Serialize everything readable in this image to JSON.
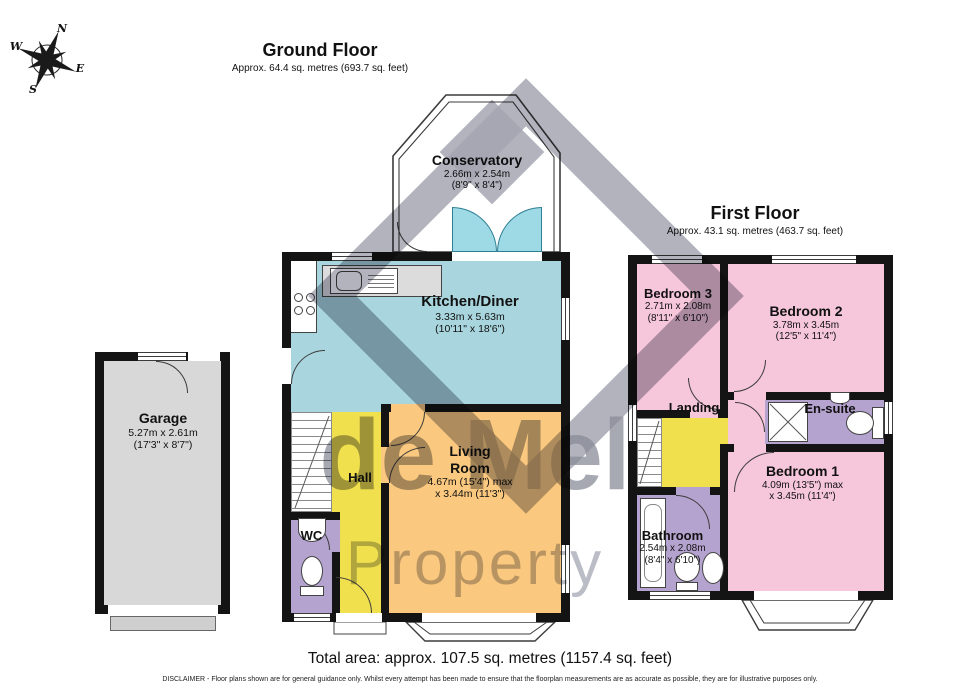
{
  "meta": {
    "background": "#ffffff"
  },
  "compass": {
    "n": "N",
    "e": "E",
    "s": "S",
    "w": "W"
  },
  "watermark": {
    "line1": "de Mel",
    "line2": "Property"
  },
  "floors": [
    {
      "title": "Ground Floor",
      "subtitle": "Approx. 64.4 sq. metres (693.7 sq. feet)",
      "rooms": [
        {
          "name": "Conservatory",
          "dims_m": "2.66m x 2.54m",
          "dims_ft": "(8'9\" x 8'4\")"
        },
        {
          "name": "Kitchen/Diner",
          "dims_m": "3.33m x 5.63m",
          "dims_ft": "(10'11\" x 18'6\")"
        },
        {
          "name": "Living Room",
          "dims_m": "4.67m (15'4\") max",
          "dims_ft": "x 3.44m (11'3\")"
        },
        {
          "name": "Hall"
        },
        {
          "name": "WC"
        },
        {
          "name": "Garage",
          "dims_m": "5.27m x 2.61m",
          "dims_ft": "(17'3\" x 8'7\")"
        }
      ]
    },
    {
      "title": "First Floor",
      "subtitle": "Approx. 43.1 sq. metres (463.7 sq. feet)",
      "rooms": [
        {
          "name": "Bedroom 3",
          "dims_m": "2.71m x 2.08m",
          "dims_ft": "(8'11\" x 6'10\")"
        },
        {
          "name": "Bedroom 2",
          "dims_m": "3.78m x 3.45m",
          "dims_ft": "(12'5\" x 11'4\")"
        },
        {
          "name": "Landing"
        },
        {
          "name": "En-suite"
        },
        {
          "name": "Bedroom 1",
          "dims_m": "4.09m (13'5\") max",
          "dims_ft": "x 3.45m (11'4\")"
        },
        {
          "name": "Bathroom",
          "dims_m": "2.54m x 2.08m",
          "dims_ft": "(8'4\" x 6'10\")"
        }
      ]
    }
  ],
  "fixtures": {
    "ground": [
      "sink-icon",
      "hob-icon",
      "counter",
      "stairs",
      "french-doors",
      "toilet-icon",
      "basin-icon",
      "bay-window"
    ],
    "first": [
      "stairs",
      "shower-icon",
      "toilet-icon",
      "basin-icon",
      "bath-icon",
      "bay-window"
    ]
  },
  "footer": {
    "total_area": "Total area: approx. 107.5 sq. metres (1157.4 sq. feet)",
    "disclaimer": "DISCLAIMER -  Floor plans shown are for general guidance only. Whilst every attempt has been made to ensure that the floorplan measurements are as accurate as possible, they are for illustrative purposes only."
  },
  "colors": {
    "kitchen": "#a9d6de",
    "living": "#fac87e",
    "hall": "#f1e04e",
    "landing": "#f1e04e",
    "bedroom": "#f6c6da",
    "sanitary": "#b5a3cf",
    "garage": "#d8d8d8",
    "wall": "#141414",
    "watermark_gray": "#9a9ca8"
  }
}
